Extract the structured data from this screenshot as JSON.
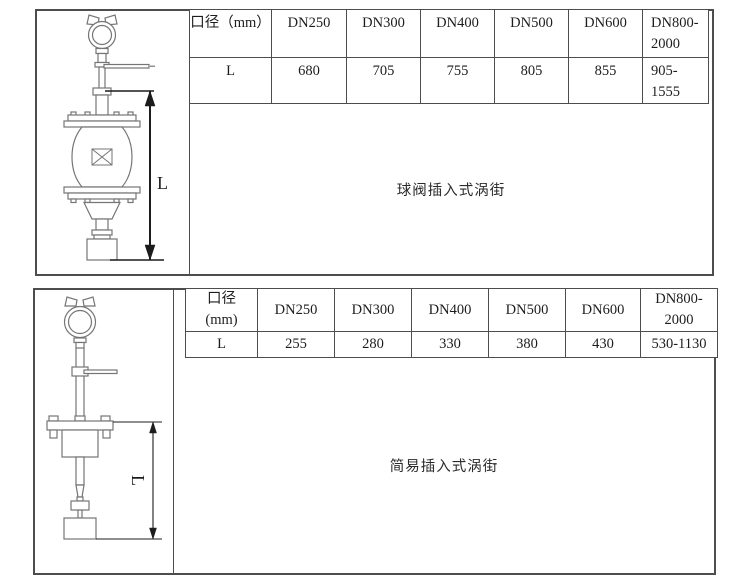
{
  "top": {
    "caption": "球阀插入式涡街",
    "dim_label": "L",
    "table": {
      "headers": [
        "口径（mm）",
        "DN250",
        "DN300",
        "DN400",
        "DN500",
        "DN600",
        "DN800-\n2000"
      ],
      "row_label": "L",
      "values": [
        "680",
        "705",
        "755",
        "805",
        "855",
        "905-\n1555"
      ]
    }
  },
  "bottom": {
    "caption": "简易插入式涡街",
    "dim_label": "L",
    "table": {
      "headers": [
        "口径\n(mm)",
        "DN250",
        "DN300",
        "DN400",
        "DN500",
        "DN600",
        "DN800-\n2000"
      ],
      "row_label": "L",
      "values": [
        "255",
        "280",
        "330",
        "380",
        "430",
        "530-1130"
      ]
    }
  },
  "colors": {
    "border": "#4d4d4d",
    "drawing_line": "#757575",
    "dimension_line": "#1c1c1c",
    "text": "#1d1d1d"
  }
}
